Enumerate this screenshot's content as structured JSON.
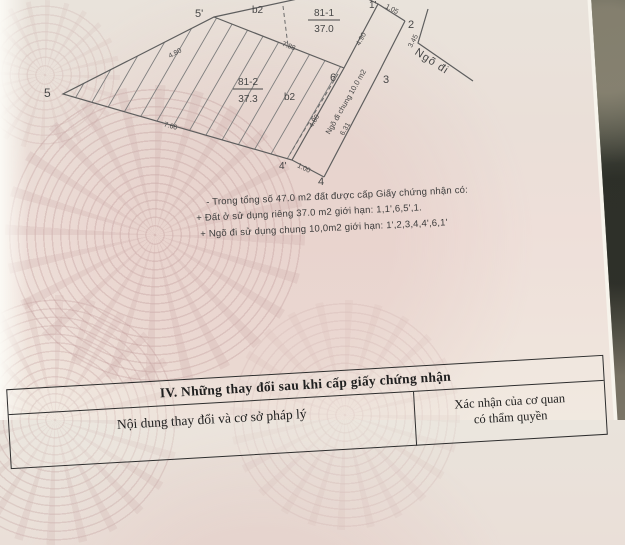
{
  "diagram": {
    "b2_top": "b2",
    "p811_id": "81-1",
    "p811_area": "37.0",
    "p812_id": "81-2",
    "p812_area": "37.3",
    "b2_side": "b2",
    "pt_5p": "5'",
    "pt_5": "5",
    "pt_4": "4",
    "pt_4p": "4'",
    "pt_6": "6",
    "pt_3": "3",
    "pt_2": "2",
    "pt_1p": "1'",
    "m_480_left": "4.80",
    "m_788": "7.88",
    "m_766": "7.66",
    "m_105": "1.05",
    "m_100": "1.00",
    "m_490": "4.90",
    "m_345": "3.45",
    "m_480_strip": "4.80",
    "m_631": "6.31",
    "strip_label": "Ngõ đi chung 10.0 m2",
    "road_label": "Ngõ đi"
  },
  "notes": {
    "line1": "- Trong tổng số 47.0 m2 đất được cấp Giấy chứng nhận có:",
    "line2": "+ Đất ở sử dụng riêng 37.0 m2 giới hạn: 1,1',6,5',1.",
    "line3": "+ Ngõ đi sử dụng chung 10,0m2 giới hạn: 1',2,3,4,4',6,1'"
  },
  "table": {
    "title": "IV. Những thay đổi sau khi cấp giấy chứng nhận",
    "col_left": "Nội dung thay đổi và cơ sở pháp lý",
    "col_right_l1": "Xác nhận của cơ quan",
    "col_right_l2": "có thẩm quyền"
  },
  "colors": {
    "paper_pink": "#ecdcd8",
    "pattern_rose": "#cf9f9f",
    "drawing_line": "#5e5e5e",
    "table_ink": "#2e2e2e",
    "photo_background_dark": "#4a4e42"
  }
}
